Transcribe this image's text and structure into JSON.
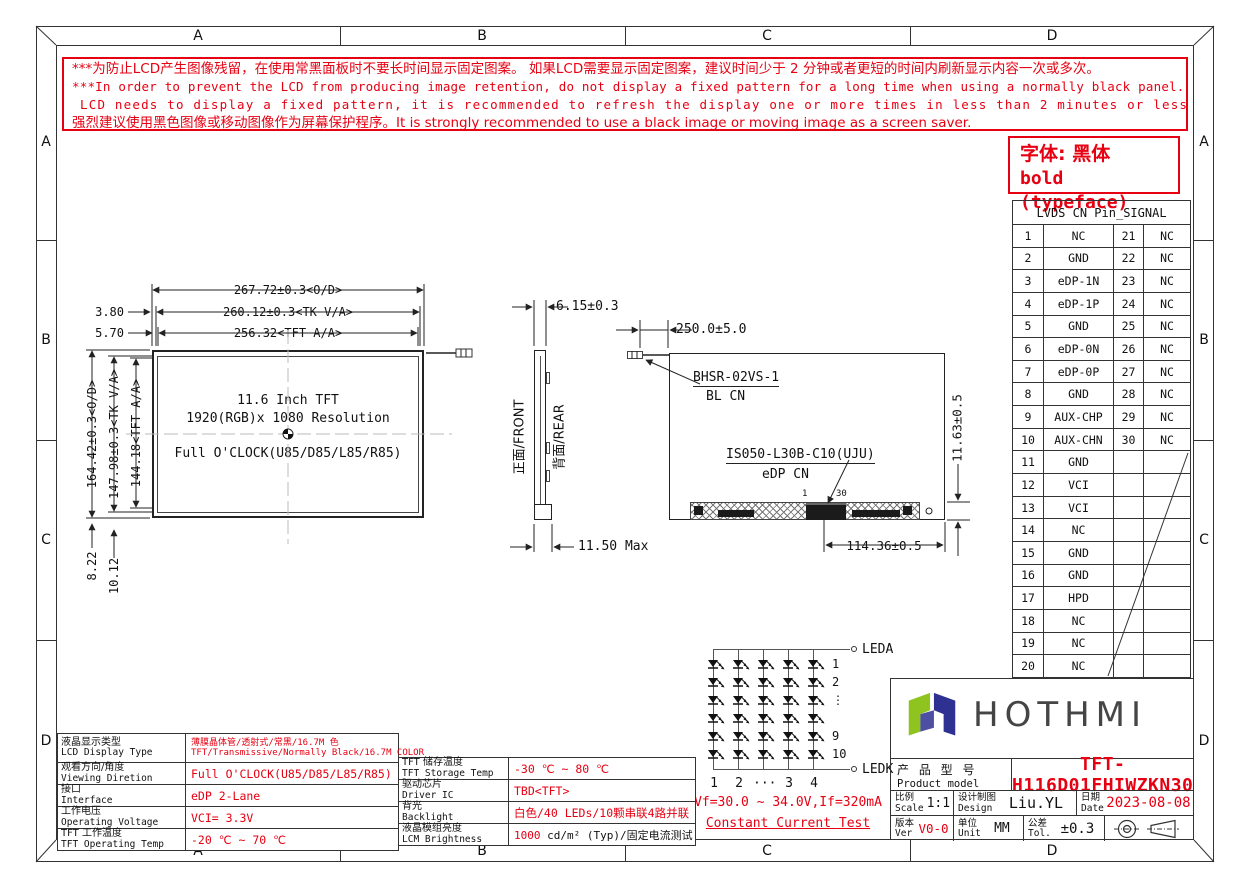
{
  "colors": {
    "red": "#e60012",
    "line": "#222222",
    "logo_green": "#8fc31f",
    "logo_navy": "#2e3192"
  },
  "border": {
    "top": [
      "A",
      "B",
      "C",
      "D"
    ],
    "bottom": [
      "A",
      "B",
      "C",
      "D"
    ],
    "left": [
      "A",
      "B",
      "C",
      "D"
    ],
    "right": [
      "A",
      "B",
      "C",
      "D"
    ]
  },
  "warning": {
    "lines": [
      "***为防止LCD产生图像残留，在使用常黑面板时不要长时间显示固定图案。 如果LCD需要显示固定图案，建议时间少于 2 分钟或者更短的时间内刷新显示内容一次或多次。",
      "***In order to prevent the LCD from producing image retention, do not display a fixed pattern for a long time when using a normally black panel. If the",
      "LCD needs to display a fixed pattern, it is recommended to refresh the display one or more times in less than 2 minutes or less.",
      "强烈建议使用黑色图像或移动图像作为屏幕保护程序。It is strongly recommended to use a black image or moving image as a screen saver."
    ]
  },
  "typeface_note": {
    "line1": "字体: 黑体",
    "line2": "bold (typeface)"
  },
  "lvds_table": {
    "title": "LVDS CN Pin_SIGNAL",
    "rows": [
      [
        "1",
        "NC",
        "21",
        "NC"
      ],
      [
        "2",
        "GND",
        "22",
        "NC"
      ],
      [
        "3",
        "eDP-1N",
        "23",
        "NC"
      ],
      [
        "4",
        "eDP-1P",
        "24",
        "NC"
      ],
      [
        "5",
        "GND",
        "25",
        "NC"
      ],
      [
        "6",
        "eDP-0N",
        "26",
        "NC"
      ],
      [
        "7",
        "eDP-0P",
        "27",
        "NC"
      ],
      [
        "8",
        "GND",
        "28",
        "NC"
      ],
      [
        "9",
        "AUX-CHP",
        "29",
        "NC"
      ],
      [
        "10",
        "AUX-CHN",
        "30",
        "NC"
      ],
      [
        "11",
        "GND",
        "",
        ""
      ],
      [
        "12",
        "VCI",
        "",
        ""
      ],
      [
        "13",
        "VCI",
        "",
        ""
      ],
      [
        "14",
        "NC",
        "",
        ""
      ],
      [
        "15",
        "GND",
        "",
        ""
      ],
      [
        "16",
        "GND",
        "",
        ""
      ],
      [
        "17",
        "HPD",
        "",
        ""
      ],
      [
        "18",
        "NC",
        "",
        ""
      ],
      [
        "19",
        "NC",
        "",
        ""
      ],
      [
        "20",
        "NC",
        "",
        ""
      ]
    ]
  },
  "front_view": {
    "dim_width_od": "267.72±0.3<O/D>",
    "dim_width_tk": "260.12±0.3<TK V/A>",
    "dim_width_aa": "256.32<TFT A/A>",
    "offset_left_1": "3.80",
    "offset_left_2": "5.70",
    "dim_height_od": "164.42±0.3<O/D>",
    "dim_height_tk": "147.98±0.3<TK V/A>",
    "dim_height_aa": "144.18<TFT A/A>",
    "offset_bottom_1": "8.22",
    "offset_bottom_2": "10.12",
    "center_line_1": "11.6 Inch TFT",
    "center_line_2": "1920(RGB)x 1080 Resolution",
    "center_line_3": "Full O'CLOCK(U85/D85/L85/R85)"
  },
  "side_view": {
    "front_label": "正面/FRONT",
    "rear_label": "背面/REAR",
    "thickness": "6.15±0.3",
    "max_thickness": "11.50 Max"
  },
  "rear_view": {
    "cable_dim": "250.0±5.0",
    "bl_connector": "BHSR-02VS-1",
    "bl_cn": "BL CN",
    "edp_connector": "IS050-L30B-C10(UJU)",
    "edp_cn": "eDP CN",
    "pcb_height": "11.63±0.5",
    "connector_offset": "114.36±0.5",
    "pin_first": "1",
    "pin_last": "30"
  },
  "led_circuit": {
    "anode": "LEDA",
    "cathode": "LEDK",
    "rows": 6,
    "cols": 5,
    "row_labels": [
      "1",
      "2",
      "⋮",
      "",
      "9",
      "10"
    ],
    "col_labels": [
      "1",
      "2",
      "···",
      "3",
      "4"
    ],
    "spec": "Vf=30.0 ~ 34.0V,If=320mA",
    "test": "Constant Current Test"
  },
  "spec_table_left": {
    "rows": [
      {
        "label_zh": "液晶显示类型",
        "label_en": "LCD Display Type",
        "value": "薄膜晶体管/透射式/常黑/16.7M 色",
        "value2": "TFT/Transmissive/Normally Black/16.7M COLOR"
      },
      {
        "label_zh": "观看方向/角度",
        "label_en": "Viewing Diretion",
        "value": "Full O'CLOCK(U85/D85/L85/R85)"
      },
      {
        "label_zh": "接口",
        "label_en": "Interface",
        "value": "eDP 2-Lane"
      },
      {
        "label_zh": "工作电压",
        "label_en": "Operating Voltage",
        "value": "VCI= 3.3V"
      },
      {
        "label_zh": "TFT 工作温度",
        "label_en": "TFT Operating Temp",
        "value": "-20 ℃ ~ 70 ℃"
      }
    ]
  },
  "spec_table_right": {
    "rows": [
      {
        "label_zh": "TFT 储存温度",
        "label_en": "TFT Storage Temp",
        "value": "-30 ℃ ~ 80 ℃"
      },
      {
        "label_zh": "驱动芯片",
        "label_en": "Driver IC",
        "value": "TBD<TFT>"
      },
      {
        "label_zh": "背光",
        "label_en": "Backlight",
        "value": "白色/40 LEDs/10颗串联4路并联"
      },
      {
        "label_zh": "液晶模组亮度",
        "label_en": "LCM Brightness",
        "value_red": "1000",
        "value_black": " cd/m² (Typ)/固定电流测试"
      }
    ]
  },
  "title_block": {
    "brand": "HOTHMI",
    "product_label_zh": "产 品 型 号",
    "product_label_en": "Product model",
    "product_model": "TFT-H116D01FHIWZKN30",
    "scale_zh": "比例",
    "scale_en": "Scale",
    "scale": "1:1",
    "design_zh": "设计制图",
    "design_en": "Design",
    "designer": "Liu.YL",
    "date_zh": "日期",
    "date_en": "Date",
    "date": "2023-08-08",
    "ver_zh": "版本",
    "ver_en": "Ver",
    "version": "V0-0",
    "unit_zh": "单位",
    "unit_en": "Unit",
    "unit": "MM",
    "tol_zh": "公差",
    "tol_en": "Tol.",
    "tolerance": "±0.3"
  }
}
